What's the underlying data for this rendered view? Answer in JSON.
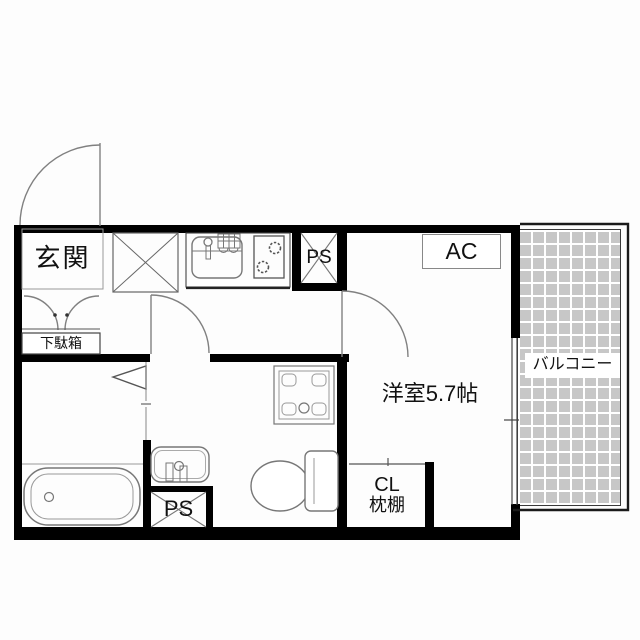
{
  "floorplan": {
    "labels": {
      "genkan": "玄関",
      "getabako": "下駄箱",
      "ps_upper": "PS",
      "ps_lower": "PS",
      "ac": "AC",
      "main_room": "洋室5.7帖",
      "balcony": "バルコニー",
      "closet_line1": "CL",
      "closet_line2": "枕棚"
    },
    "colors": {
      "wall": "#000000",
      "fixture_outline": "#777777",
      "door_arc": "#808080",
      "balcony_tile": "#c7c7c7",
      "balcony_grout": "#ffffff",
      "label_text": "#111111",
      "background": "#ffffff"
    }
  }
}
